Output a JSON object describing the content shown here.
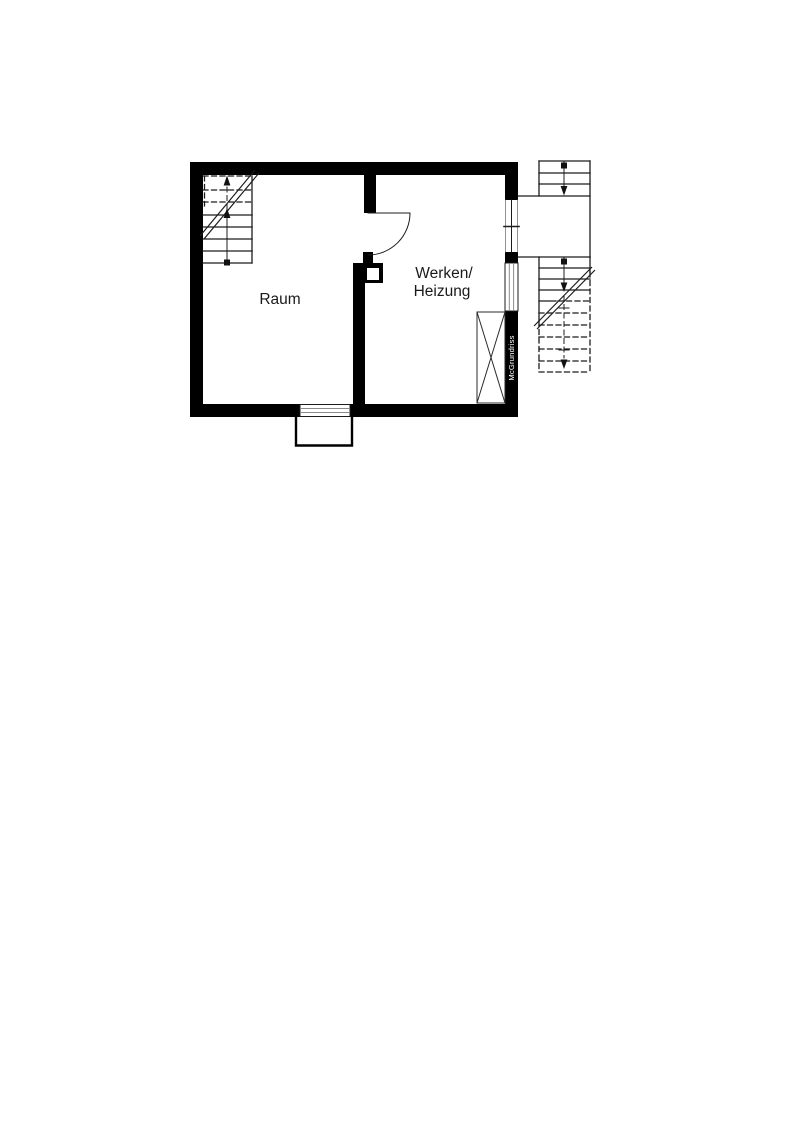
{
  "plan": {
    "title": "Basement floor plan",
    "rooms": [
      {
        "name": "Raum",
        "label": "Raum"
      },
      {
        "name": "Werken/Heizung",
        "lines": [
          "Werken/",
          "Heizung"
        ]
      }
    ],
    "watermark": {
      "text": "McGrundriss",
      "bg": "#000000",
      "fg": "#ffffff"
    },
    "colors": {
      "wall": "#000000",
      "background": "#ffffff",
      "line": "#1c1c1c",
      "window_pane": "#8a8a8a"
    },
    "symbols": [
      "interior-staircase-up-with-break-line",
      "exterior-stair-upper-down-arrow",
      "exterior-stair-lower-dashed-below-grade",
      "interior-door-quarter-swing",
      "exterior-door-opening-threshold-tick",
      "window-in-right-wall",
      "window-in-bottom-wall",
      "light-well",
      "crossed-shaft-box",
      "pillar-with-flue-hole"
    ]
  }
}
